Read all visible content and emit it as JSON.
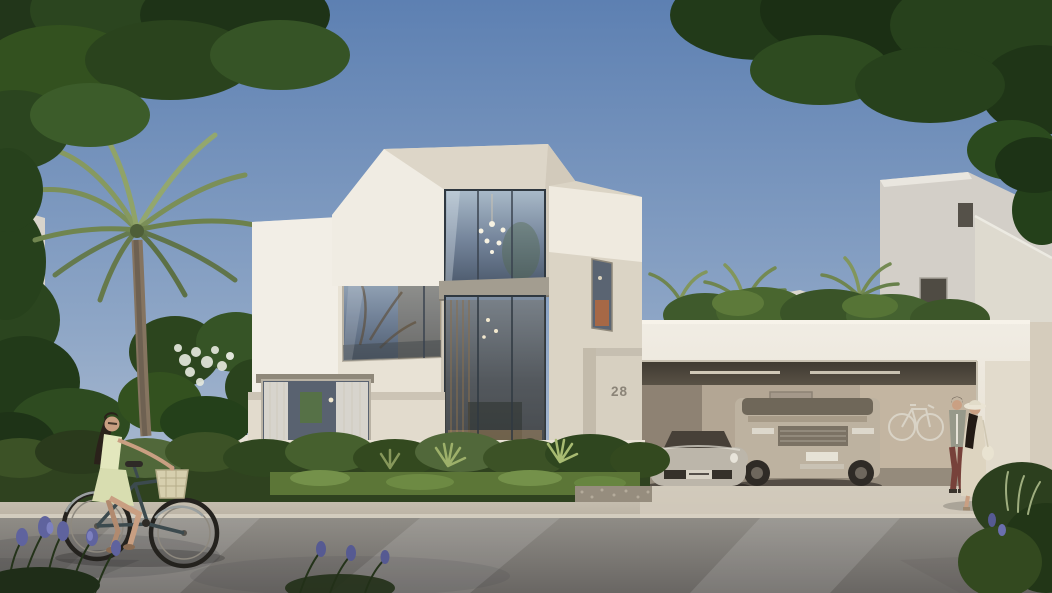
{
  "scene": {
    "description": "Photorealistic exterior rendering of a modern faceted white villa (house number 28) with a double-height glass atrium, an open double garage holding a silver sports car and a champagne SUV with a bicycle mounted on the back wall, a woman cycling past on the street, a couple strolling on the driveway, palm trees, hedges and purple flowers under a clear blue sky",
    "objects": [
      "modern white villa",
      "glass atrium with chandelier",
      "garage with two cars",
      "silver sports car",
      "champagne SUV",
      "wall-mounted bicycle",
      "woman riding bicycle",
      "walking couple",
      "palm tree",
      "overhanging trees",
      "hedge and groundcover",
      "purple flowers",
      "street and sidewalk",
      "neighbouring villas"
    ]
  },
  "house": {
    "number": "28"
  },
  "palette": {
    "sky_top": "#5d80b2",
    "sky_horizon": "#bfc9d7",
    "villa_sunlit": "#f2eee6",
    "villa_cream": "#e8e2d5",
    "villa_shadow": "#d6cfc1",
    "garage_wall": "#b3a694",
    "road": "#8f8c86",
    "sidewalk": "#c6bfb1",
    "foliage_dark": "#27411c",
    "palm_green": "#869960",
    "car_silver": "#bcb6aa",
    "suv_champagne": "#bdb2a0",
    "flower_purple": "#5f639e"
  }
}
